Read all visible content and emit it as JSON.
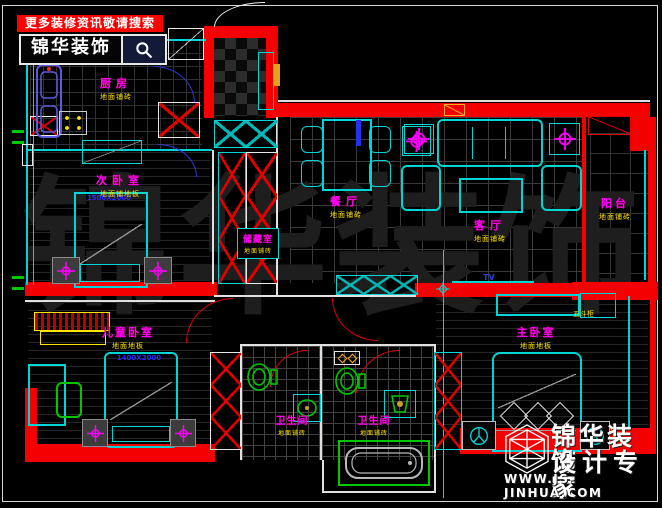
{
  "banner": {
    "headline": "更多装修资讯敬请搜索",
    "brand": "锦华装饰",
    "search_icon": "magnifier-icon"
  },
  "watermark": {
    "text": "锦华装饰"
  },
  "logo": {
    "brand": "锦华装饰",
    "tagline": "设计专家",
    "website": "WWW.JS-JINHUA.COM"
  },
  "rooms": {
    "kitchen": {
      "name": "厨房",
      "floor": "地面铺砖"
    },
    "second_bedroom": {
      "name": "次卧室",
      "floor": "地面铺地板",
      "bed_size": "1500X2000"
    },
    "storage": {
      "name": "储藏室",
      "floor": "地面铺砖"
    },
    "dining": {
      "name": "餐厅",
      "floor": "地面铺砖"
    },
    "living": {
      "name": "客厅",
      "floor": "地面铺砖",
      "tv": "TV"
    },
    "balcony": {
      "name": "阳台",
      "floor": "地面铺砖"
    },
    "kids_bedroom": {
      "name": "儿童卧室",
      "floor": "地面地板",
      "bed_size": "1400X2000"
    },
    "master_bedroom": {
      "name": "主卧室",
      "floor": "地面地板",
      "cabinet": "五斗柜"
    },
    "bath_a": {
      "name": "卫生间",
      "floor": "地面铺砖"
    },
    "bath_b": {
      "name": "卫生间",
      "floor": "地面铺砖"
    }
  },
  "colors": {
    "wall": "#f40000",
    "furniture_line": "#00d5d5",
    "room_label": "#ff00ff",
    "floor_label": "#ffe400",
    "size_label": "#2a2aff",
    "fixture": "#00c800",
    "banner_bg": "#ff0000"
  }
}
